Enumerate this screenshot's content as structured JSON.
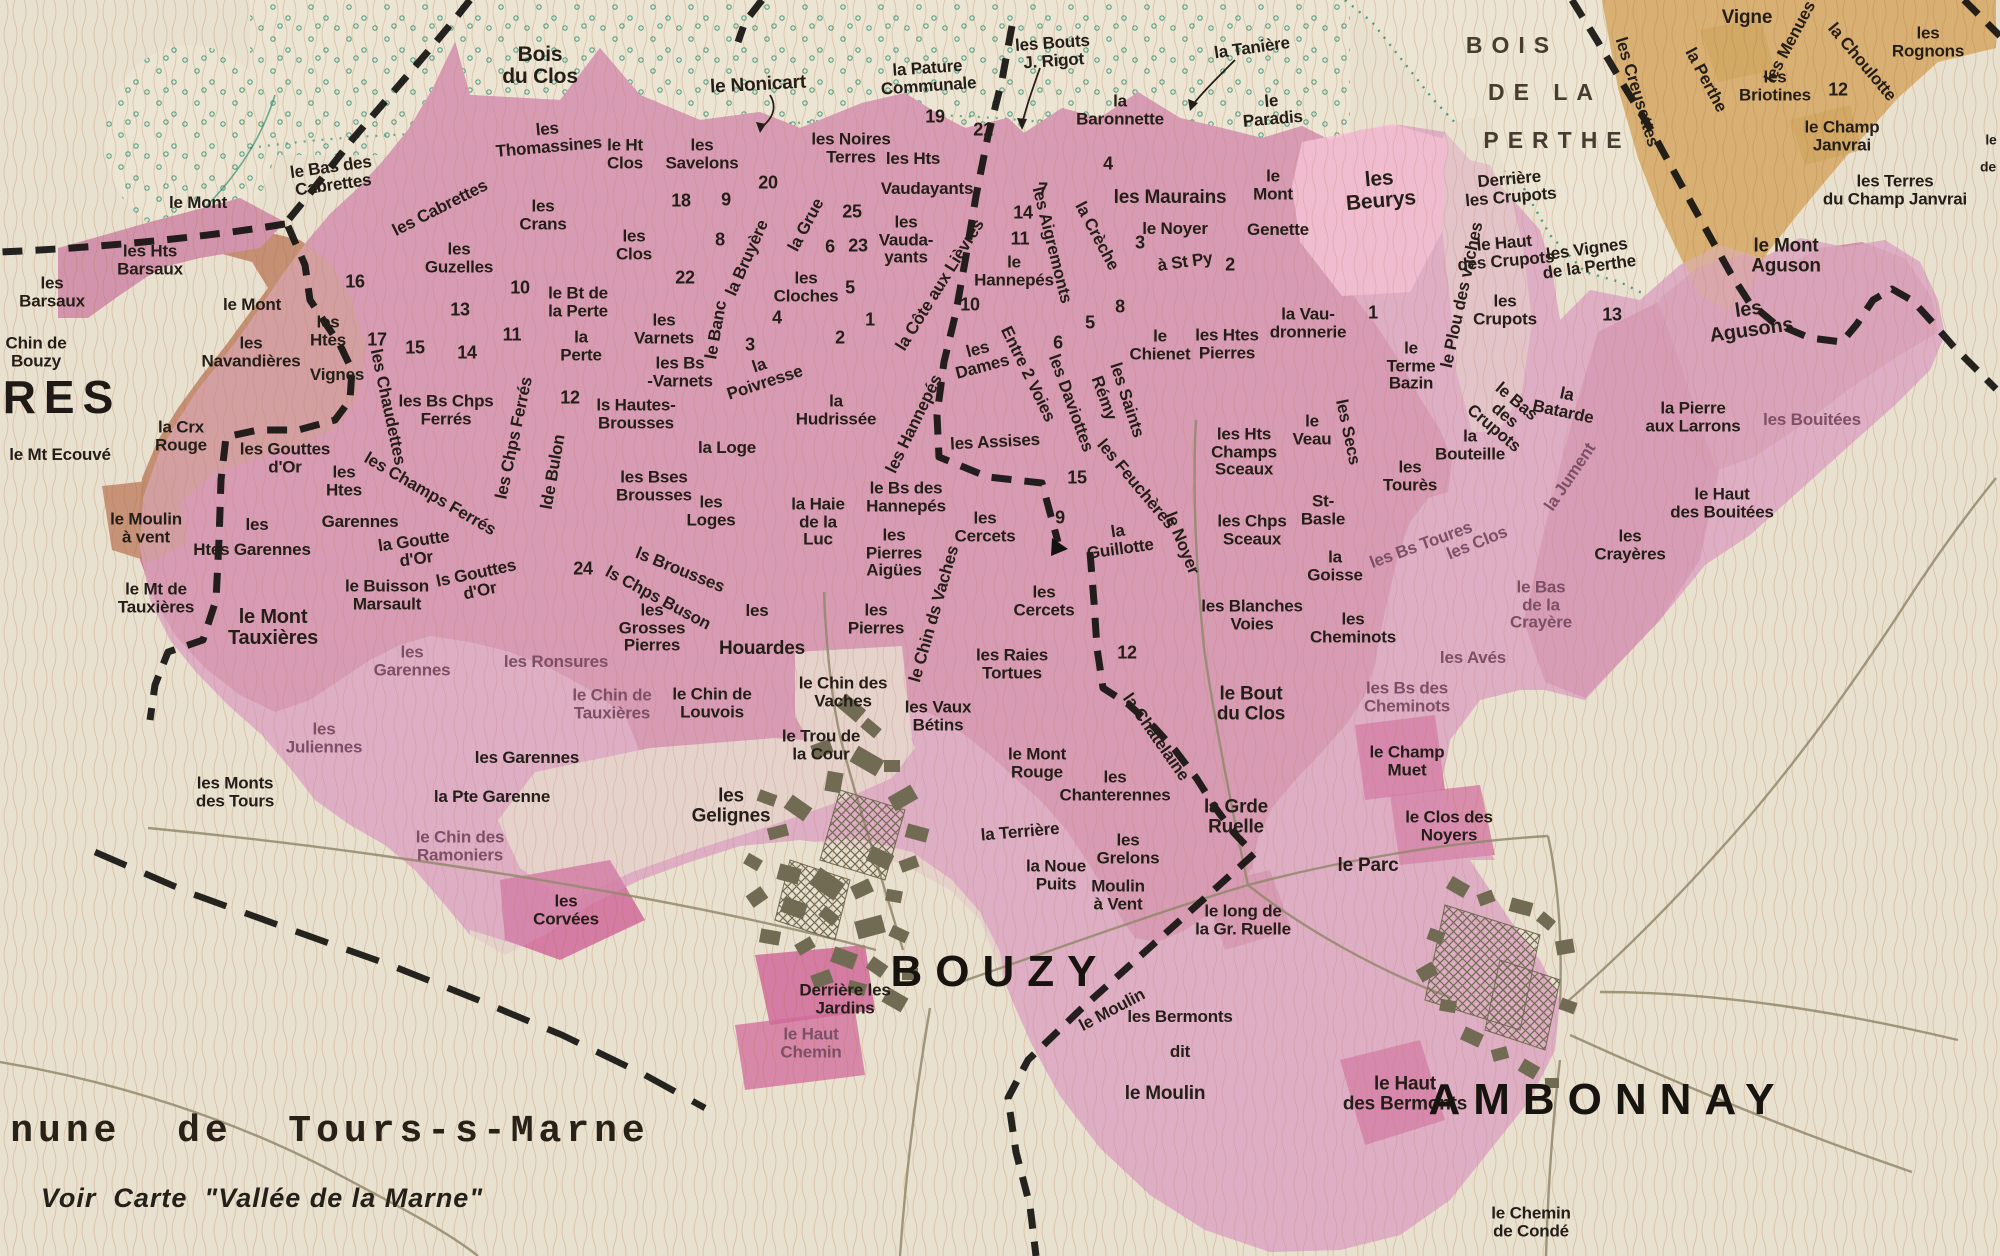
{
  "map": {
    "width": 2000,
    "height": 1256
  },
  "palette": {
    "cream": "#e9e1cf",
    "creamWood": "#ece5d3",
    "pinkDeep": "#cd7f9c",
    "pinkMed": "#d294ac",
    "pinkLight": "#dfaec5",
    "pinkBright": "#f8c3d6",
    "magenta": "#d06a9b",
    "brown": "#c28a6e",
    "tan": "#d8b173",
    "tanDark": "#c89a4c",
    "wood": "#2e8f74",
    "boundary": "#141210",
    "road": "#93886c",
    "townGray": "#716b54",
    "ink": "#241d18",
    "muted": "#7d4f66",
    "hach": "#b06a38",
    "hachPink": "#9c4a63",
    "parcel": "#7d6a55"
  },
  "labels": [
    {
      "t": "Bois\ndu Clos",
      "x": 540,
      "y": 66,
      "s": 21
    },
    {
      "t": "le Nonicart",
      "x": 758,
      "y": 85,
      "s": 19,
      "r": -3
    },
    {
      "t": "les\nThomassines",
      "x": 548,
      "y": 138,
      "r": -5
    },
    {
      "t": "le Ht\nClos",
      "x": 625,
      "y": 154
    },
    {
      "t": "les\nSavelons",
      "x": 702,
      "y": 154
    },
    {
      "t": "les Noires\nTerres",
      "x": 851,
      "y": 148
    },
    {
      "t": "les Hts",
      "x": 913,
      "y": 159
    },
    {
      "t": "Vaudayants",
      "x": 927,
      "y": 189
    },
    {
      "t": "la Pature\nCommunale",
      "x": 928,
      "y": 77,
      "r": -4
    },
    {
      "t": "les Bouts\nJ. Rigot",
      "x": 1053,
      "y": 52,
      "r": -4
    },
    {
      "t": "la Tanière",
      "x": 1252,
      "y": 48,
      "r": -8
    },
    {
      "t": "la\nBaronnette",
      "x": 1120,
      "y": 110
    },
    {
      "t": "le\nParadis",
      "x": 1272,
      "y": 110,
      "r": -5
    },
    {
      "t": "les Maurains",
      "x": 1170,
      "y": 198,
      "s": 19
    },
    {
      "t": "le\nMont",
      "x": 1273,
      "y": 185
    },
    {
      "t": "Genette",
      "x": 1278,
      "y": 230
    },
    {
      "t": "le Noyer",
      "x": 1175,
      "y": 229
    },
    {
      "t": "à St Py",
      "x": 1185,
      "y": 262,
      "r": -8
    },
    {
      "t": "les\nBeurys",
      "x": 1380,
      "y": 190,
      "s": 21,
      "r": -5
    },
    {
      "t": "Derrière\nles Crupots",
      "x": 1510,
      "y": 188,
      "r": -5
    },
    {
      "t": "le Haut\ndes Crupots",
      "x": 1505,
      "y": 252,
      "r": -5
    },
    {
      "t": "les\nCrupots",
      "x": 1505,
      "y": 310
    },
    {
      "t": "le Bas\ndes\nCrupots",
      "x": 1505,
      "y": 415,
      "r": 40
    },
    {
      "t": "les Vignes\nde la Perthe",
      "x": 1588,
      "y": 258,
      "r": -8
    },
    {
      "t": "le Plou des vaches",
      "x": 1462,
      "y": 295,
      "r": -78
    },
    {
      "t": "BOIS",
      "x": 1512,
      "y": 46,
      "c": "bois"
    },
    {
      "t": "DE LA",
      "x": 1545,
      "y": 93,
      "c": "bois"
    },
    {
      "t": "PERTHE",
      "x": 1557,
      "y": 141,
      "c": "bois"
    },
    {
      "t": "les Creusettes",
      "x": 1637,
      "y": 92,
      "r": 73
    },
    {
      "t": "la Perthe",
      "x": 1706,
      "y": 80,
      "r": 62
    },
    {
      "t": "Vigne",
      "x": 1747,
      "y": 18,
      "s": 19
    },
    {
      "t": "les Menues",
      "x": 1790,
      "y": 42,
      "r": -62
    },
    {
      "t": "la Choulotte",
      "x": 1862,
      "y": 62,
      "r": 50
    },
    {
      "t": "les\nRognons",
      "x": 1928,
      "y": 42
    },
    {
      "t": "les\nBriotines",
      "x": 1775,
      "y": 86
    },
    {
      "t": "le Champ\nJanvrai",
      "x": 1842,
      "y": 136
    },
    {
      "t": "les Terres\ndu Champ Janvrai",
      "x": 1895,
      "y": 190
    },
    {
      "t": "le Mont\nAguson",
      "x": 1786,
      "y": 256,
      "s": 19
    },
    {
      "t": "les\nAgusons",
      "x": 1750,
      "y": 320,
      "s": 20,
      "r": -8
    },
    {
      "t": "le",
      "x": 1991,
      "y": 140,
      "c": "sm"
    },
    {
      "t": "de",
      "x": 1988,
      "y": 167,
      "c": "sm"
    },
    {
      "t": "le Mont",
      "x": 198,
      "y": 203
    },
    {
      "t": "les Hts\nBarsaux",
      "x": 150,
      "y": 260
    },
    {
      "t": "les\nBarsaux",
      "x": 52,
      "y": 292
    },
    {
      "t": "Chin de\nBouzy",
      "x": 36,
      "y": 352
    },
    {
      "t": "RES",
      "x": 62,
      "y": 398,
      "c": "res"
    },
    {
      "t": "le Mt Ecouvé",
      "x": 60,
      "y": 455
    },
    {
      "t": "la Crx\nRouge",
      "x": 181,
      "y": 436
    },
    {
      "t": "le Mont",
      "x": 252,
      "y": 305
    },
    {
      "t": "les\nNavandières",
      "x": 251,
      "y": 352
    },
    {
      "t": "les\nHtes",
      "x": 328,
      "y": 331
    },
    {
      "t": "Vignes",
      "x": 337,
      "y": 375
    },
    {
      "t": "les Chaudettes",
      "x": 388,
      "y": 407,
      "r": 78
    },
    {
      "t": "les Gouttes\nd'Or",
      "x": 285,
      "y": 458
    },
    {
      "t": "les\nHtes",
      "x": 344,
      "y": 481
    },
    {
      "t": "Garennes",
      "x": 360,
      "y": 522
    },
    {
      "t": "la Goutte\nd'Or",
      "x": 415,
      "y": 550,
      "r": -8
    },
    {
      "t": "ls Gouttes\nd'Or",
      "x": 478,
      "y": 582,
      "r": -12
    },
    {
      "t": "les",
      "x": 257,
      "y": 525
    },
    {
      "t": "Htes Garennes",
      "x": 252,
      "y": 550
    },
    {
      "t": "les Champs Ferrés",
      "x": 430,
      "y": 494,
      "r": 30
    },
    {
      "t": "le Moulin\nà vent",
      "x": 146,
      "y": 528
    },
    {
      "t": "le Mt de\nTauxières",
      "x": 156,
      "y": 598
    },
    {
      "t": "le Buisson\nMarsault",
      "x": 387,
      "y": 595
    },
    {
      "t": "le Mont\nTauxières",
      "x": 273,
      "y": 628,
      "s": 20
    },
    {
      "t": "les\nGarennes",
      "x": 412,
      "y": 661,
      "c": "muted"
    },
    {
      "t": "les Ronsures",
      "x": 556,
      "y": 662,
      "c": "muted"
    },
    {
      "t": "le Chin de\nTauxières",
      "x": 612,
      "y": 704,
      "c": "muted"
    },
    {
      "t": "les\nJuliennes",
      "x": 324,
      "y": 738,
      "c": "muted"
    },
    {
      "t": "les Monts\ndes Tours",
      "x": 235,
      "y": 792
    },
    {
      "t": "les Garennes",
      "x": 527,
      "y": 758
    },
    {
      "t": "la Pte Garenne",
      "x": 492,
      "y": 797
    },
    {
      "t": "le Chin des\nRamoniers",
      "x": 460,
      "y": 846,
      "c": "muted"
    },
    {
      "t": "les\nGuzelles",
      "x": 459,
      "y": 258
    },
    {
      "t": "le Bas des\nCabrettes",
      "x": 332,
      "y": 176,
      "r": -8
    },
    {
      "t": "les Cabrettes",
      "x": 440,
      "y": 208,
      "r": -27
    },
    {
      "t": "les\nCrans",
      "x": 543,
      "y": 215
    },
    {
      "t": "les\nClos",
      "x": 634,
      "y": 245
    },
    {
      "t": "la Grue",
      "x": 806,
      "y": 225,
      "r": -62
    },
    {
      "t": "la Bruyère",
      "x": 747,
      "y": 258,
      "r": -66
    },
    {
      "t": "le Banc",
      "x": 716,
      "y": 330,
      "r": -80
    },
    {
      "t": "les\nCloches",
      "x": 806,
      "y": 287
    },
    {
      "t": "les\nVauda-\nyants",
      "x": 906,
      "y": 240
    },
    {
      "t": "la Côte aux Lièvres",
      "x": 940,
      "y": 285,
      "r": -58
    },
    {
      "t": "le\nHannepés",
      "x": 1014,
      "y": 271
    },
    {
      "t": "les\nDames",
      "x": 980,
      "y": 358,
      "r": -15
    },
    {
      "t": "Entre 2 Voies",
      "x": 1028,
      "y": 374,
      "r": 64
    },
    {
      "t": "les Aigremonts",
      "x": 1052,
      "y": 245,
      "r": 76
    },
    {
      "t": "la Crèche",
      "x": 1097,
      "y": 236,
      "r": 62
    },
    {
      "t": "le Bt de\nla Perte",
      "x": 578,
      "y": 302
    },
    {
      "t": "la\nPerte",
      "x": 581,
      "y": 346
    },
    {
      "t": "les Bs Chps\nFerrés",
      "x": 446,
      "y": 410
    },
    {
      "t": "les Chps Ferrés",
      "x": 514,
      "y": 438,
      "r": -78
    },
    {
      "t": "lde Bulon",
      "x": 553,
      "y": 472,
      "r": -80
    },
    {
      "t": "les\nVarnets",
      "x": 664,
      "y": 329
    },
    {
      "t": "les Bs\n-Varnets",
      "x": 680,
      "y": 372
    },
    {
      "t": "ls Hautes-\nBrousses",
      "x": 636,
      "y": 414
    },
    {
      "t": "la\nPoivresse",
      "x": 762,
      "y": 374,
      "r": -18
    },
    {
      "t": "la\nHudrissée",
      "x": 836,
      "y": 410
    },
    {
      "t": "la Loge",
      "x": 727,
      "y": 448
    },
    {
      "t": "les Bses\nBrousses",
      "x": 654,
      "y": 486
    },
    {
      "t": "les\nLoges",
      "x": 711,
      "y": 511
    },
    {
      "t": "les Hannepés",
      "x": 914,
      "y": 424,
      "r": -64
    },
    {
      "t": "les Assises",
      "x": 995,
      "y": 442,
      "r": -3
    },
    {
      "t": "la Haie\nde la\nLuc",
      "x": 818,
      "y": 522
    },
    {
      "t": "le Bs des\nHannepés",
      "x": 906,
      "y": 497
    },
    {
      "t": "les\nPierres\nAigües",
      "x": 894,
      "y": 553
    },
    {
      "t": "les\nCercets",
      "x": 985,
      "y": 527
    },
    {
      "t": "la\nGuillotte",
      "x": 1119,
      "y": 540,
      "r": -8
    },
    {
      "t": "ls Brousses",
      "x": 680,
      "y": 570,
      "r": 22
    },
    {
      "t": "ls Chps Buson",
      "x": 658,
      "y": 598,
      "r": 28
    },
    {
      "t": "les\nGrosses\nPierres",
      "x": 652,
      "y": 628
    },
    {
      "t": "les",
      "x": 757,
      "y": 611
    },
    {
      "t": "Houardes",
      "x": 762,
      "y": 649,
      "s": 19
    },
    {
      "t": "les\nPierres",
      "x": 876,
      "y": 619
    },
    {
      "t": "le Chin des\nVaches",
      "x": 843,
      "y": 692
    },
    {
      "t": "les Vaux\nBétins",
      "x": 938,
      "y": 716
    },
    {
      "t": "le Chin ds Vaches",
      "x": 934,
      "y": 614,
      "r": -74
    },
    {
      "t": "les Raies\nTortues",
      "x": 1012,
      "y": 664
    },
    {
      "t": "les\nCercets",
      "x": 1044,
      "y": 601
    },
    {
      "t": "le Trou de\nla Cour",
      "x": 821,
      "y": 745
    },
    {
      "t": "les\nGelignes",
      "x": 731,
      "y": 806,
      "s": 19
    },
    {
      "t": "le Chin de\nLouvois",
      "x": 712,
      "y": 703
    },
    {
      "t": "la Châtelaine",
      "x": 1156,
      "y": 737,
      "r": 55
    },
    {
      "t": "les Feuchères",
      "x": 1136,
      "y": 484,
      "r": 50
    },
    {
      "t": "le Noyer",
      "x": 1182,
      "y": 543,
      "r": 68
    },
    {
      "t": "les Saints",
      "x": 1127,
      "y": 400,
      "r": 72
    },
    {
      "t": "Rémy",
      "x": 1104,
      "y": 398,
      "r": 70
    },
    {
      "t": "les Daviottes",
      "x": 1071,
      "y": 403,
      "r": 70
    },
    {
      "t": "le\nChienet",
      "x": 1160,
      "y": 345
    },
    {
      "t": "les Htes\nPierres",
      "x": 1227,
      "y": 344
    },
    {
      "t": "la Vau-\ndronnerie",
      "x": 1308,
      "y": 323
    },
    {
      "t": "le\nTerme\nBazin",
      "x": 1411,
      "y": 366
    },
    {
      "t": "les Hts\nChamps\nSceaux",
      "x": 1244,
      "y": 452
    },
    {
      "t": "le\nVeau",
      "x": 1312,
      "y": 430
    },
    {
      "t": "les Secs",
      "x": 1348,
      "y": 432,
      "r": 78
    },
    {
      "t": "les\nTourès",
      "x": 1410,
      "y": 476
    },
    {
      "t": "St-\nBasle",
      "x": 1323,
      "y": 510
    },
    {
      "t": "les Chps\nSceaux",
      "x": 1252,
      "y": 530
    },
    {
      "t": "la\nGoisse",
      "x": 1335,
      "y": 566
    },
    {
      "t": "les Blanches\nVoies",
      "x": 1252,
      "y": 615
    },
    {
      "t": "les\nCheminots",
      "x": 1353,
      "y": 628
    },
    {
      "t": "le Bout\ndu Clos",
      "x": 1251,
      "y": 704,
      "s": 19
    },
    {
      "t": "les Bs des\nCheminots",
      "x": 1407,
      "y": 697,
      "c": "muted"
    },
    {
      "t": "le Champ\nMuet",
      "x": 1407,
      "y": 761
    },
    {
      "t": "les Avés",
      "x": 1473,
      "y": 658,
      "c": "muted"
    },
    {
      "t": "le Bas\nde la\nCrayère",
      "x": 1541,
      "y": 605,
      "c": "muted"
    },
    {
      "t": "les\nCrayères",
      "x": 1630,
      "y": 545
    },
    {
      "t": "le Haut\ndes Bouitées",
      "x": 1722,
      "y": 503
    },
    {
      "t": "les Bouitées",
      "x": 1812,
      "y": 420,
      "c": "muted"
    },
    {
      "t": "la Pierre\naux Larrons",
      "x": 1693,
      "y": 417
    },
    {
      "t": "la\nBatarde",
      "x": 1565,
      "y": 403,
      "r": 12
    },
    {
      "t": "la\nBouteille",
      "x": 1470,
      "y": 445
    },
    {
      "t": "la Jument",
      "x": 1570,
      "y": 477,
      "r": -56,
      "c": "muted"
    },
    {
      "t": "les Bs Toures",
      "x": 1421,
      "y": 545,
      "r": -20,
      "c": "muted"
    },
    {
      "t": "les Clos",
      "x": 1477,
      "y": 543,
      "r": -22,
      "c": "muted"
    },
    {
      "t": "le Mont\nRouge",
      "x": 1037,
      "y": 763
    },
    {
      "t": "les\nChanterennes",
      "x": 1115,
      "y": 786
    },
    {
      "t": "la Terrière",
      "x": 1020,
      "y": 832,
      "r": -5
    },
    {
      "t": "la Noue\nPuits",
      "x": 1056,
      "y": 875
    },
    {
      "t": "les\nGrelons",
      "x": 1128,
      "y": 849
    },
    {
      "t": "Moulin\nà Vent",
      "x": 1118,
      "y": 895
    },
    {
      "t": "la Grde\nRuelle",
      "x": 1236,
      "y": 817,
      "s": 19
    },
    {
      "t": "le long de\nla Gr. Ruelle",
      "x": 1243,
      "y": 920
    },
    {
      "t": "le Parc",
      "x": 1368,
      "y": 866,
      "s": 19
    },
    {
      "t": "le Clos des\nNoyers",
      "x": 1449,
      "y": 826
    },
    {
      "t": "le Moulin",
      "x": 1112,
      "y": 1010,
      "r": -28
    },
    {
      "t": "les Bermonts",
      "x": 1180,
      "y": 1017
    },
    {
      "t": "dit",
      "x": 1180,
      "y": 1052
    },
    {
      "t": "le Moulin",
      "x": 1165,
      "y": 1094,
      "s": 19
    },
    {
      "t": "le Haut\ndes Bermonts",
      "x": 1405,
      "y": 1094,
      "s": 19
    },
    {
      "t": "BOUZY",
      "x": 1000,
      "y": 972,
      "c": "town"
    },
    {
      "t": "AMBONNAY",
      "x": 1608,
      "y": 1100,
      "c": "town"
    },
    {
      "t": "Derrière les\nJardins",
      "x": 845,
      "y": 999
    },
    {
      "t": "le Haut\nChemin",
      "x": 811,
      "y": 1043,
      "c": "muted"
    },
    {
      "t": "les\nCorvées",
      "x": 566,
      "y": 910
    },
    {
      "t": "le Chemin\nde Condé",
      "x": 1531,
      "y": 1222
    },
    {
      "t": "nune  de  Tours-s-Marne",
      "x": 330,
      "y": 1132,
      "c": "commune"
    },
    {
      "t": "Voir  Carte  \"Vallée de la Marne\"",
      "x": 262,
      "y": 1198,
      "c": "voir"
    },
    {
      "t": "19",
      "x": 935,
      "y": 117,
      "c": "num"
    },
    {
      "t": "21",
      "x": 983,
      "y": 130,
      "c": "num"
    },
    {
      "t": "18",
      "x": 681,
      "y": 201,
      "c": "num"
    },
    {
      "t": "9",
      "x": 726,
      "y": 200,
      "c": "num"
    },
    {
      "t": "20",
      "x": 768,
      "y": 183,
      "c": "num"
    },
    {
      "t": "25",
      "x": 852,
      "y": 212,
      "c": "num"
    },
    {
      "t": "8",
      "x": 720,
      "y": 240,
      "c": "num"
    },
    {
      "t": "6",
      "x": 830,
      "y": 247,
      "c": "num"
    },
    {
      "t": "23",
      "x": 858,
      "y": 246,
      "c": "num"
    },
    {
      "t": "5",
      "x": 850,
      "y": 288,
      "c": "num"
    },
    {
      "t": "1",
      "x": 870,
      "y": 320,
      "c": "num"
    },
    {
      "t": "2",
      "x": 840,
      "y": 338,
      "c": "num"
    },
    {
      "t": "4",
      "x": 777,
      "y": 318,
      "c": "num"
    },
    {
      "t": "3",
      "x": 750,
      "y": 345,
      "c": "num"
    },
    {
      "t": "22",
      "x": 685,
      "y": 278,
      "c": "num"
    },
    {
      "t": "10",
      "x": 520,
      "y": 288,
      "c": "num"
    },
    {
      "t": "13",
      "x": 460,
      "y": 310,
      "c": "num"
    },
    {
      "t": "11",
      "x": 512,
      "y": 335,
      "c": "num"
    },
    {
      "t": "15",
      "x": 415,
      "y": 348,
      "c": "num"
    },
    {
      "t": "14",
      "x": 467,
      "y": 353,
      "c": "num"
    },
    {
      "t": "12",
      "x": 570,
      "y": 398,
      "c": "num"
    },
    {
      "t": "24",
      "x": 583,
      "y": 569,
      "c": "num"
    },
    {
      "t": "16",
      "x": 355,
      "y": 282,
      "c": "num"
    },
    {
      "t": "17",
      "x": 377,
      "y": 340,
      "c": "num"
    },
    {
      "t": "4",
      "x": 1108,
      "y": 164,
      "c": "num"
    },
    {
      "t": "7",
      "x": 1043,
      "y": 190,
      "c": "num"
    },
    {
      "t": "14",
      "x": 1023,
      "y": 213,
      "c": "num"
    },
    {
      "t": "11",
      "x": 1020,
      "y": 239,
      "c": "num"
    },
    {
      "t": "10",
      "x": 970,
      "y": 305,
      "c": "num"
    },
    {
      "t": "3",
      "x": 1140,
      "y": 243,
      "c": "num"
    },
    {
      "t": "2",
      "x": 1230,
      "y": 265,
      "c": "num"
    },
    {
      "t": "8",
      "x": 1120,
      "y": 307,
      "c": "num"
    },
    {
      "t": "5",
      "x": 1090,
      "y": 323,
      "c": "num"
    },
    {
      "t": "6",
      "x": 1058,
      "y": 343,
      "c": "num"
    },
    {
      "t": "15",
      "x": 1077,
      "y": 478,
      "c": "num"
    },
    {
      "t": "9",
      "x": 1060,
      "y": 518,
      "c": "num"
    },
    {
      "t": "1",
      "x": 1373,
      "y": 313,
      "c": "num"
    },
    {
      "t": "12",
      "x": 1127,
      "y": 653,
      "c": "num"
    },
    {
      "t": "13",
      "x": 1612,
      "y": 315,
      "c": "num"
    },
    {
      "t": "12",
      "x": 1838,
      "y": 90,
      "c": "num"
    }
  ]
}
